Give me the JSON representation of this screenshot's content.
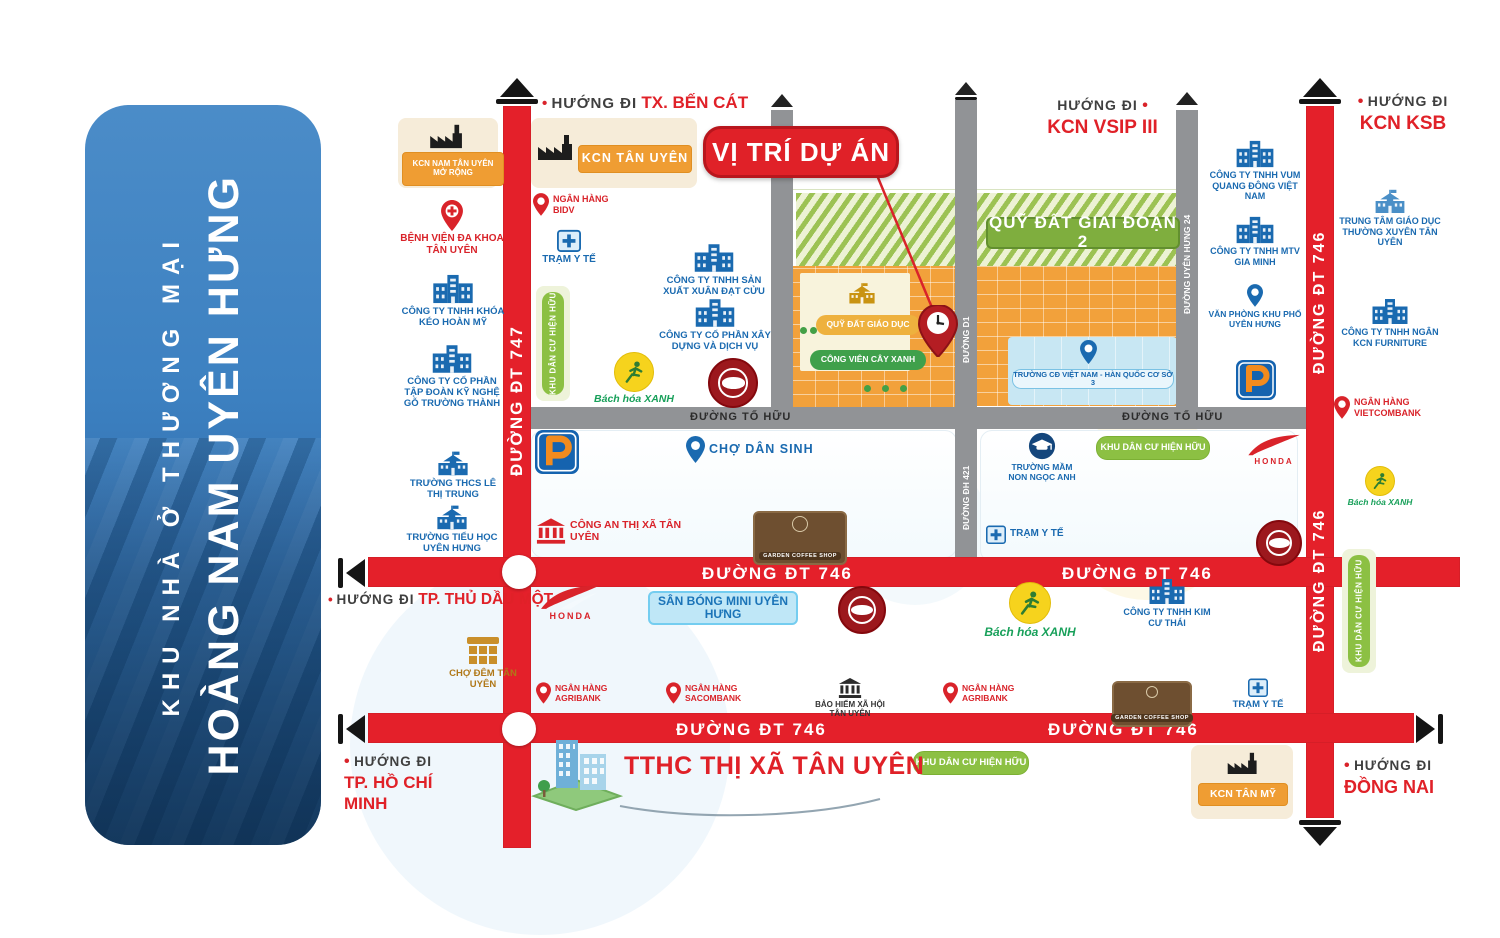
{
  "ui": {
    "bullet": "•"
  },
  "banner": {
    "subtitle": "KHU NHÀ Ở THƯƠNG MẠI",
    "title": "HOÀNG NAM UYÊN HƯNG"
  },
  "callout": {
    "label": "VỊ TRÍ DỰ ÁN"
  },
  "directions": {
    "ben_cat": {
      "prefix": "HƯỚNG ĐI",
      "dest": "TX. BẾN CÁT"
    },
    "vsip3": {
      "prefix": "HƯỚNG ĐI",
      "dest": "KCN VSIP III"
    },
    "ksb": {
      "prefix": "HƯỚNG ĐI",
      "dest": "KCN KSB"
    },
    "thu_dau_mot": {
      "prefix": "HƯỚNG ĐI",
      "dest": "TP. THỦ DẦU MỘT"
    },
    "ho_chi_minh": {
      "prefix": "HƯỚNG ĐI",
      "dest": "TP. HỒ CHÍ MINH"
    },
    "dong_nai": {
      "prefix": "HƯỚNG ĐI",
      "dest": "ĐỒNG NAI"
    }
  },
  "roads": {
    "dt747": "ĐƯỜNG ĐT 747",
    "dt746": "ĐƯỜNG ĐT 746",
    "to_huu": "ĐƯỜNG TỐ HỮU",
    "d1": "ĐƯỜNG D1",
    "dh421": "ĐƯỜNG ĐH 421",
    "uyen_hung_24": "ĐƯỜNG UYÊN HƯNG 24"
  },
  "zones": {
    "kcn_nam_tan_uyen": "KCN NAM TÂN UYÊN MỞ RỘNG",
    "kcn_tan_uyen": "KCN TÂN UYÊN",
    "kcn_tan_my": "KCN TÂN MỸ",
    "phase2": "QUỸ ĐẤT GIAI ĐOẠN 2",
    "edu_land": "QUỸ ĐẤT GIÁO DỤC",
    "park": "CÔNG VIÊN CÂY XANH",
    "khu_dan_cu": "KHU DÂN CƯ HIỆN HỮU",
    "san_bong": "SÂN BÓNG MINI UYÊN HƯNG",
    "tthc": "TTHC THỊ XÃ TÂN UYÊN"
  },
  "pois": {
    "benh_vien": "BỆNH VIỆN ĐA KHOA TÂN UYÊN",
    "khoa_keo": "CÔNG TY TNHH KHÓA KÉO HOÀN MỸ",
    "go_truong_thanh": "CÔNG TY CỔ PHẦN TẬP ĐOÀN KỸ NGHỆ GỖ TRƯỜNG THÀNH",
    "thcs": "TRƯỜNG THCS LÊ THỊ TRUNG",
    "tieu_hoc": "TRƯỜNG TIỂU HỌC UYÊN HƯNG",
    "bidv": "NGÂN HÀNG BIDV",
    "tram_y_te": "TRẠM Y TẾ",
    "xuan_dat_cuu": "CÔNG TY TNHH SẢN XUẤT XUÂN ĐẠT CỬU",
    "xay_dung_dich_vu": "CÔNG TY CỔ PHẦN XÂY DỰNG VÀ DỊCH VỤ",
    "cho_dan_sinh": "CHỢ DÂN SINH",
    "cong_an": "CÔNG AN THỊ XÃ TÂN UYÊN",
    "mam_non": "TRƯỜNG MẦM NON NGỌC ANH",
    "vum_quang_dong": "CÔNG TY TNHH VUM QUANG ĐÔNG VIỆT NAM",
    "gia_minh": "CÔNG TY TNHH MTV GIA MINH",
    "van_phong": "VĂN PHÒNG KHU PHỐ UYÊN HƯNG",
    "ttgdtx": "TRUNG TÂM GIÁO DỤC THƯỜNG XUYÊN TÂN UYÊN",
    "ngan_kcn": "CÔNG TY TNHH NGÂN KCN FURNITURE",
    "vietcombank": "NGÂN HÀNG VIETCOMBANK",
    "agribank": "NGÂN HÀNG AGRIBANK",
    "sacombank": "NGÂN HÀNG SACOMBANK",
    "bhxh": "BẢO HIỂM XÃ HỘI TÂN UYÊN",
    "kim_cu_thai": "CÔNG TY TNHH KIM CƯ THÁI",
    "cho_dem": "CHỢ ĐÊM TÂN UYÊN",
    "college": "TRƯỜNG CĐ VIỆT NAM - HÀN QUỐC CƠ SỞ 3"
  },
  "brands": {
    "honda": "HONDA",
    "bach_hoa": "Bách hóa",
    "xanh": "XANH",
    "garden_coffee": "GARDEN COFFEE SHOP"
  },
  "colors": {
    "road_red": "#e4202a",
    "road_gray": "#919396",
    "parcel_orange": "#f2a13b",
    "green_badge": "#8cc043",
    "blue_text": "#1a6ab0",
    "red_text": "#d9232a",
    "banner_blue": "#3b7fc0"
  }
}
